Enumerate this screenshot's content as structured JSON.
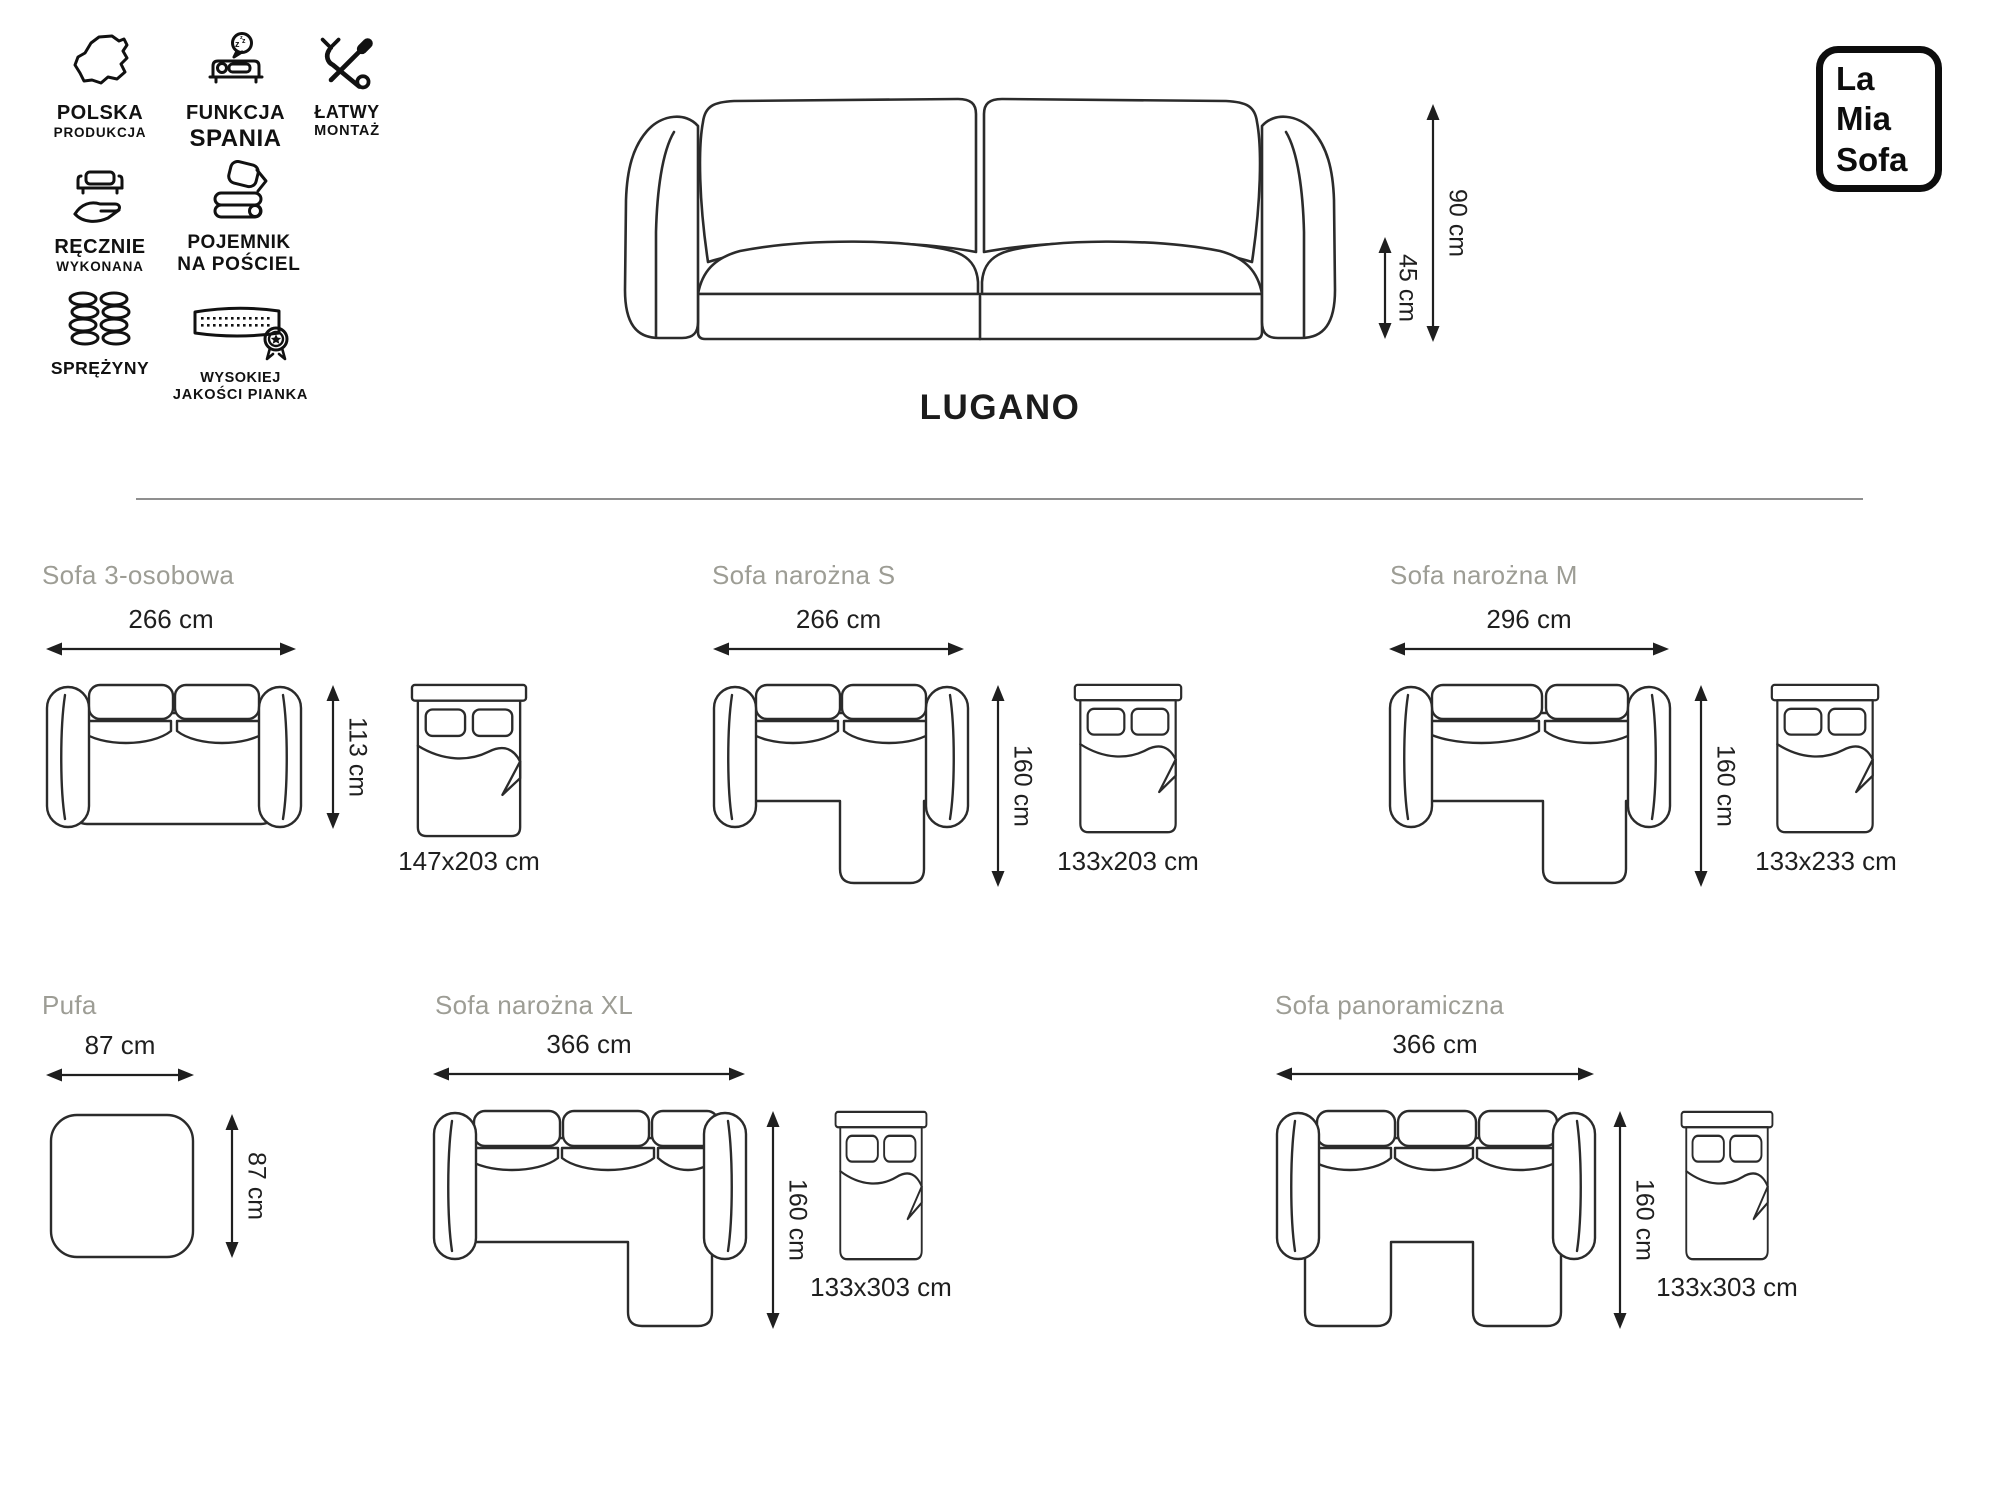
{
  "badges": {
    "polska": {
      "line1": "POLSKA",
      "line2": "PRODUKCJA"
    },
    "funkcja": {
      "line1": "FUNKCJA",
      "line2": "SPANIA"
    },
    "latwy": {
      "line1": "ŁATWY",
      "line2": "MONTAŻ"
    },
    "recznie": {
      "line1": "RĘCZNIE",
      "line2": "WYKONANA"
    },
    "pojemnik": {
      "line1": "POJEMNIK",
      "line2": "NA POŚCIEL"
    },
    "sprezyny": {
      "line1": "SPRĘŻYNY"
    },
    "pianka": {
      "line1": "WYSOKIEJ",
      "line2": "JAKOŚCI PIANKA"
    }
  },
  "product": {
    "title": "LUGANO",
    "total_height": "90 cm",
    "seat_height": "45 cm"
  },
  "logo": {
    "line1": "La",
    "line2": "Mia",
    "line3": "Sofa"
  },
  "variants": [
    {
      "name": "Sofa 3-osobowa",
      "width": "266 cm",
      "depth": "113 cm",
      "bed": "147x203 cm"
    },
    {
      "name": "Sofa narożna S",
      "width": "266 cm",
      "depth": "160 cm",
      "bed": "133x203 cm"
    },
    {
      "name": "Sofa narożna M",
      "width": "296 cm",
      "depth": "160 cm",
      "bed": "133x233 cm"
    },
    {
      "name": "Pufa",
      "width": "87 cm",
      "depth": "87 cm"
    },
    {
      "name": "Sofa narożna XL",
      "width": "366 cm",
      "depth": "160 cm",
      "bed": "133x303 cm"
    },
    {
      "name": "Sofa panoramiczna",
      "width": "366 cm",
      "depth": "160 cm",
      "bed": "133x303 cm"
    }
  ],
  "colors": {
    "line": "#2b2b2b",
    "title_gray": "#9d9d95",
    "divider": "#8f8f8f"
  }
}
